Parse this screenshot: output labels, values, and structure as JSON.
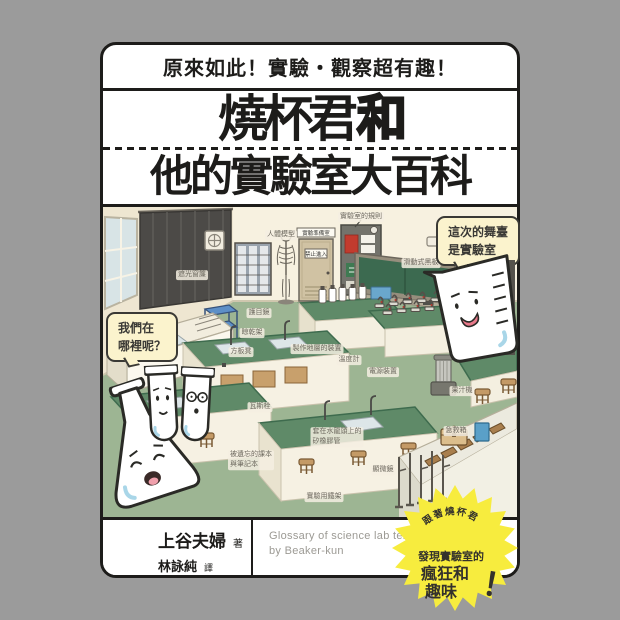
{
  "cover": {
    "tagline": "原來如此！實驗・觀察超有趣！",
    "title_main": "燒杯君",
    "title_and": "和",
    "title_line2": "他的實驗室大百科"
  },
  "bubbles": {
    "stage": "這次的舞臺\n是實驗室",
    "where": "我們在\n哪裡呢？"
  },
  "signs": {
    "prep_room": "實驗準備室",
    "no_entry": "禁止進入"
  },
  "labels": [
    {
      "text": "遮光窗簾",
      "x": 89,
      "y": 68
    },
    {
      "text": "人體模型",
      "x": 178,
      "y": 28
    },
    {
      "text": "實驗室的規則",
      "x": 258,
      "y": 10
    },
    {
      "text": "滑動式黑板",
      "x": 318,
      "y": 56
    },
    {
      "text": "護目鏡",
      "x": 156,
      "y": 106
    },
    {
      "text": "晾乾架",
      "x": 149,
      "y": 126
    },
    {
      "text": "方板凳",
      "x": 138,
      "y": 145
    },
    {
      "text": "製作地層的裝置",
      "x": 214,
      "y": 142
    },
    {
      "text": "溫度計",
      "x": 246,
      "y": 153
    },
    {
      "text": "電源裝置",
      "x": 280,
      "y": 165
    },
    {
      "text": "瓦斯栓",
      "x": 157,
      "y": 200
    },
    {
      "text": "果汁機",
      "x": 359,
      "y": 184
    },
    {
      "text": "急救箱",
      "x": 353,
      "y": 224
    },
    {
      "text": "套在水龍頭上的\n矽橡膠管",
      "x": 234,
      "y": 230
    },
    {
      "text": "被遺忘的課本\n與筆記本",
      "x": 148,
      "y": 253
    },
    {
      "text": "顯微鏡",
      "x": 280,
      "y": 263
    },
    {
      "text": "實驗用鐵架",
      "x": 221,
      "y": 290
    }
  ],
  "badge": {
    "arc": "跟著燒杯君",
    "line1": "發現實驗室的",
    "line2": "瘋狂和",
    "line3": "趣味",
    "bang": "！"
  },
  "footer": {
    "author": "上谷夫婦",
    "author_role": "著",
    "translator": "林詠純",
    "translator_role": "譯",
    "english_line1": "Glossary of science lab terms",
    "english_line2": "by Beaker-kun"
  },
  "colors": {
    "background": "#9b9b9b",
    "ink": "#1d1c1a",
    "bubble_fill": "#fbf3cd",
    "badge_yellow": "#f7ec3e",
    "chalkboard_green": "#3c6a50",
    "floor_green": "#9db593",
    "bench_green": "#5f8a68",
    "cart_blue": "#5d8fc7",
    "glass_blue": "#a9d6e8"
  }
}
